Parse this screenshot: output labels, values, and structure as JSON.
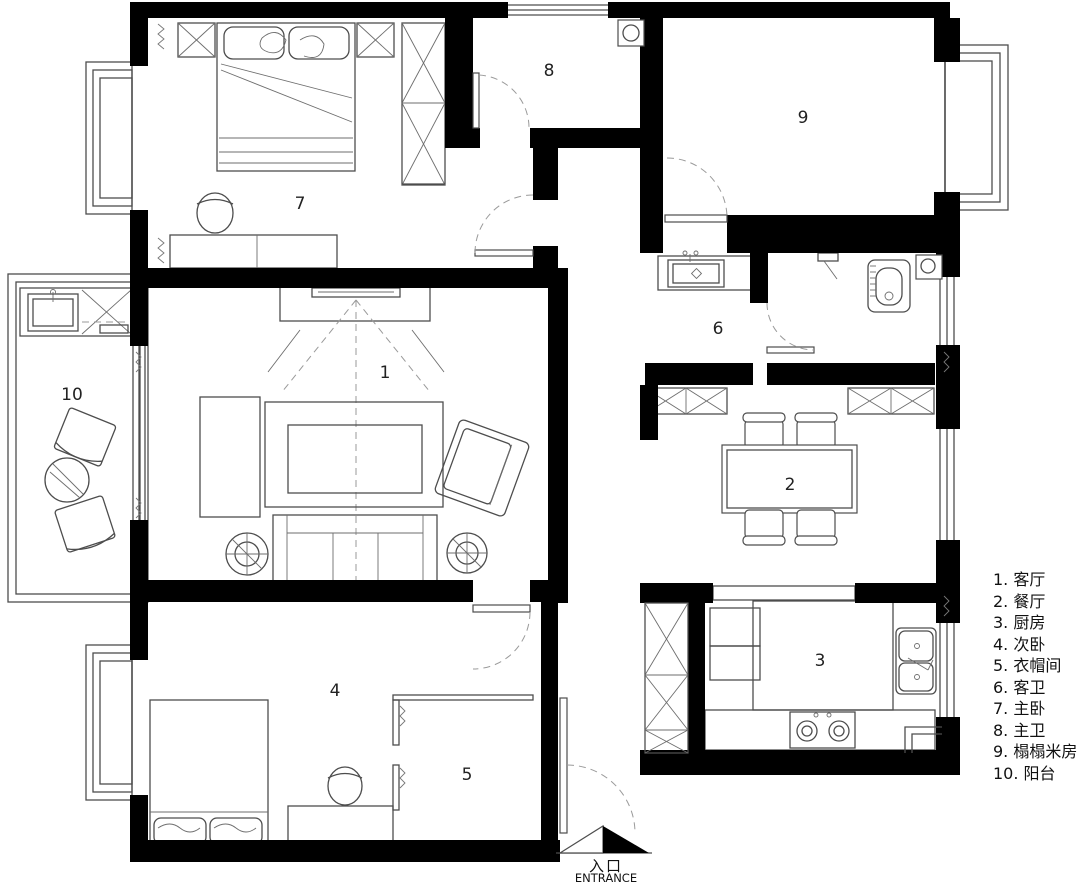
{
  "colors": {
    "wall": "#000000",
    "furniture_line": "#4d4d4d",
    "dashed_line": "#9a9a9a",
    "background": "#ffffff",
    "text": "#111111"
  },
  "rooms": [
    {
      "id": "living-room",
      "number": "1",
      "label": "客厅"
    },
    {
      "id": "dining-room",
      "number": "2",
      "label": "餐厅"
    },
    {
      "id": "kitchen",
      "number": "3",
      "label": "厨房"
    },
    {
      "id": "second-bedroom",
      "number": "4",
      "label": "次卧"
    },
    {
      "id": "walk-in-closet",
      "number": "5",
      "label": "衣帽间"
    },
    {
      "id": "guest-bathroom",
      "number": "6",
      "label": "客卫"
    },
    {
      "id": "master-bedroom",
      "number": "7",
      "label": "主卧"
    },
    {
      "id": "master-bathroom",
      "number": "8",
      "label": "主卫"
    },
    {
      "id": "tatami-room",
      "number": "9",
      "label": "榻榻米房"
    },
    {
      "id": "balcony",
      "number": "10",
      "label": "阳台"
    }
  ],
  "legend": {
    "items": [
      "1. 客厅",
      "2. 餐厅",
      "3. 厨房",
      "4. 次卧",
      "5. 衣帽间",
      "6. 客卫",
      "7. 主卧",
      "8. 主卫",
      "9. 榻榻米房",
      "10. 阳台"
    ]
  },
  "entrance": {
    "label_zh": "入口",
    "label_en": "ENTRANCE"
  }
}
